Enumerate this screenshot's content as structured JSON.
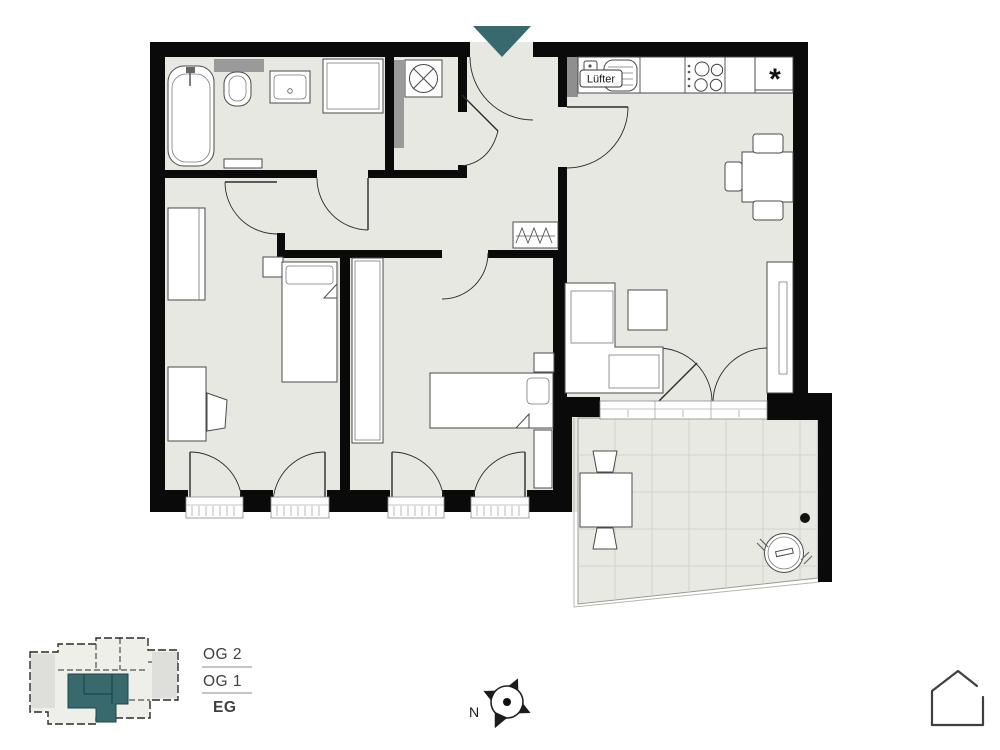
{
  "plan": {
    "labels": {
      "ventilation": "Lüfter",
      "freezer": "*"
    }
  },
  "footer": {
    "floors": [
      {
        "label": "OG 2",
        "active": false
      },
      {
        "label": "OG 1",
        "active": false
      },
      {
        "label": "EG",
        "active": true
      }
    ],
    "compass": {
      "label": "N"
    }
  },
  "colors": {
    "accent": "#38696d",
    "wall": "#0a0a0a",
    "floor": "#e8e8e2"
  }
}
